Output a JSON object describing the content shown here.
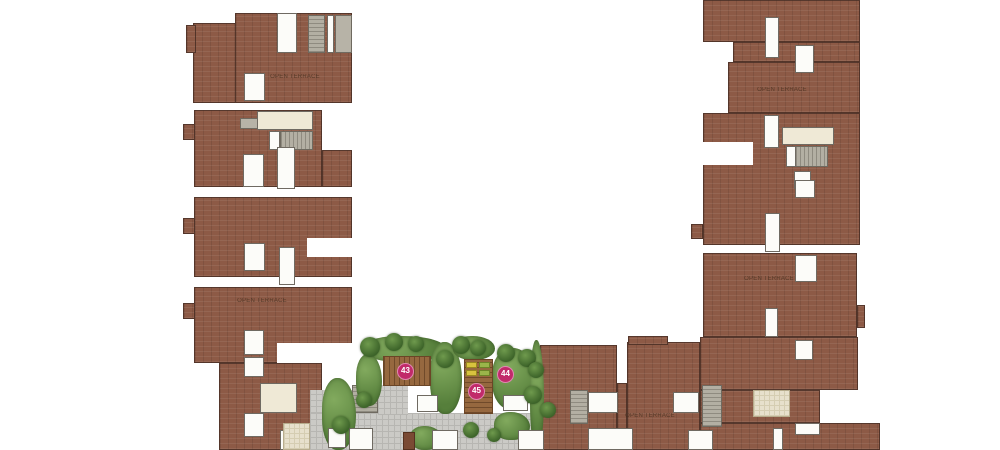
{
  "plan": {
    "title": "terrace-amenity-floor-plan",
    "markers": [
      {
        "id": "43",
        "x": 405,
        "y": 371
      },
      {
        "id": "44",
        "x": 505,
        "y": 374
      },
      {
        "id": "45",
        "x": 476,
        "y": 391
      }
    ],
    "terrace_labels": [
      {
        "text": "OPEN TERRACE",
        "x": 295,
        "y": 77
      },
      {
        "text": "OPEN TERRACE",
        "x": 262,
        "y": 301
      },
      {
        "text": "OPEN TERRACE",
        "x": 782,
        "y": 90
      },
      {
        "text": "OPEN TERRACE",
        "x": 769,
        "y": 279
      },
      {
        "text": "OPEN TERRACE",
        "x": 650,
        "y": 416
      }
    ],
    "colors": {
      "background": "#ffffff",
      "terrace_brick": "#8d5a46",
      "outline": "#42362a",
      "room_fill": "#fcfcf9",
      "lobby_cream": "#efe9d6",
      "stair_gray": "#b3afa3",
      "paver_gray": "#cbcac6",
      "tile_beige": "#e7e0cc",
      "deck_wood": "#96683f",
      "garden_green": "#567f3b",
      "tree_green": "#3c6329",
      "marker_fill": "#c12a6a",
      "marker_ring": "#e087b2",
      "marker_text": "#ffffff",
      "lounger_yellow": "#d8c23e",
      "lounger_green": "#9ab54a"
    }
  }
}
